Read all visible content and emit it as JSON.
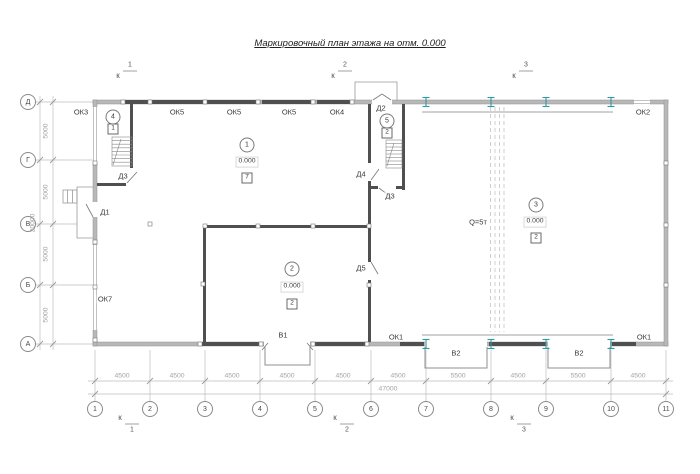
{
  "title": "Маркировочный план этажа на отм. 0.000",
  "axes": {
    "rows": [
      "Д",
      "Г",
      "В",
      "Б",
      "А"
    ],
    "cols": [
      "1",
      "2",
      "3",
      "4",
      "5",
      "6",
      "7",
      "8",
      "9",
      "10",
      "11"
    ]
  },
  "dims": {
    "row_segments": [
      "5000",
      "5000",
      "5000",
      "5000"
    ],
    "row_total": "20000",
    "col_segments": [
      "4500",
      "4500",
      "4500",
      "4500",
      "4500",
      "4500",
      "5500",
      "4500",
      "5500",
      "4500"
    ],
    "col_total": "47000"
  },
  "sections": {
    "letter": "к",
    "n1": "1",
    "n2": "2",
    "n3": "3"
  },
  "rooms": {
    "r1": {
      "num": "1",
      "level": "0.000",
      "floor": "7"
    },
    "r2": {
      "num": "2",
      "level": "0.000",
      "floor": "2"
    },
    "r3": {
      "num": "3",
      "level": "0.000",
      "floor": "2"
    },
    "r4": {
      "num": "4",
      "floor": "1"
    },
    "r5": {
      "num": "5",
      "floor": "2"
    }
  },
  "openings": {
    "ok1": "ОК1",
    "ok2": "ОК2",
    "ok3": "ОК3",
    "ok4": "ОК4",
    "ok5": "ОК5",
    "ok7": "ОК7",
    "d1": "Д1",
    "d2": "Д2",
    "d3": "Д3",
    "d4": "Д4",
    "d5": "Д5",
    "v1": "В1",
    "v2": "В2"
  },
  "crane": {
    "capacity": "Q=5т"
  },
  "colors": {
    "wall": "#b8b8b8",
    "wall_edge": "#8f8f8f",
    "glazing": "#4f4f4f",
    "steel_column": "#2f9ba1",
    "dim_line": "#b5b5b5",
    "text": "#3a3a3a"
  }
}
